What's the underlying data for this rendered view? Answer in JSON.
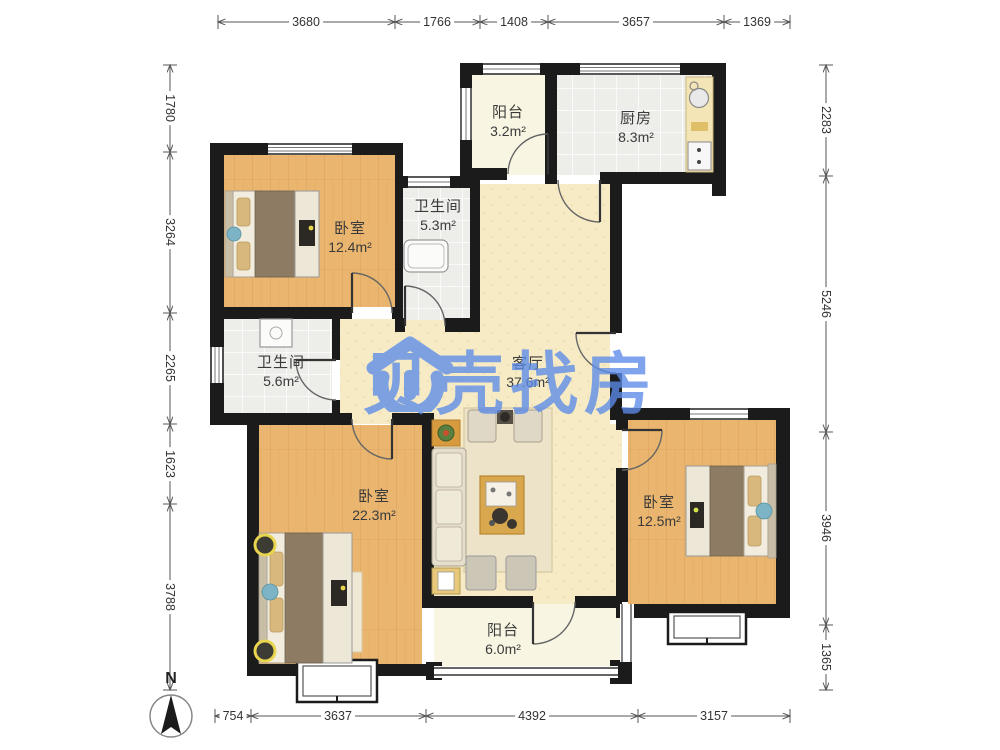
{
  "watermark": {
    "brand": "贝壳找房"
  },
  "north": {
    "label": "N"
  },
  "rooms": [
    {
      "id": "balcony-top",
      "name": "阳台",
      "area": "3.2m²"
    },
    {
      "id": "kitchen",
      "name": "厨房",
      "area": "8.3m²"
    },
    {
      "id": "bedroom-top-left",
      "name": "卧室",
      "area": "12.4m²"
    },
    {
      "id": "bathroom-1",
      "name": "卫生间",
      "area": "5.3m²"
    },
    {
      "id": "bathroom-2",
      "name": "卫生间",
      "area": "5.6m²"
    },
    {
      "id": "living-room",
      "name": "客厅",
      "area": "37.6m²"
    },
    {
      "id": "bedroom-bottom-left",
      "name": "卧室",
      "area": "22.3m²"
    },
    {
      "id": "bedroom-right",
      "name": "卧室",
      "area": "12.5m²"
    },
    {
      "id": "balcony-bottom",
      "name": "阳台",
      "area": "6.0m²"
    }
  ],
  "dimensions": {
    "top": [
      "3680",
      "1766",
      "1408",
      "3657",
      "1369"
    ],
    "left": [
      "1780",
      "3264",
      "2265",
      "1623",
      "3788"
    ],
    "right": [
      "2283",
      "5246",
      "3946",
      "1365"
    ],
    "bottom": [
      "754",
      "3637",
      "4392",
      "3157"
    ]
  },
  "colors": {
    "wall": "#1b1b1b",
    "wood_floor": "#eab56e",
    "living_floor": "#f7ebc6",
    "balcony_floor": "#f8f6e2",
    "tile_floor": "#ededea",
    "watermark_blue": "#5c8be8"
  }
}
